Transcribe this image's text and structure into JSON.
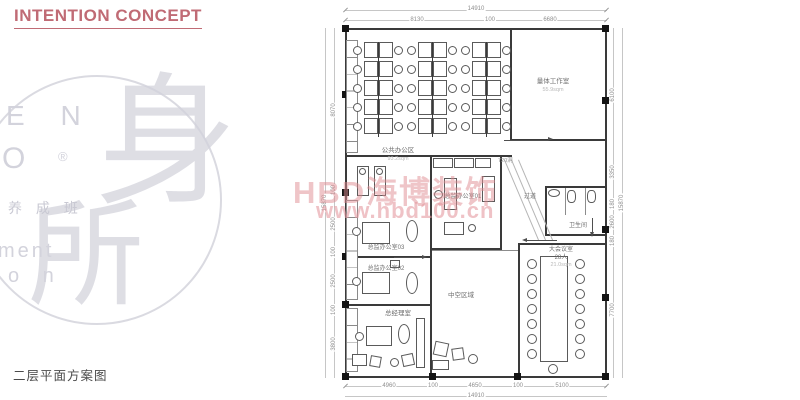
{
  "page": {
    "title": "INTENTION CONCEPT",
    "caption": "二层平面方案图"
  },
  "logo": {
    "fragment1": "E N",
    "fragment2": "O",
    "registered": "®",
    "fragment3": "养 成 班",
    "fragment4": "ment",
    "fragment5": "o n",
    "seal_char1": "身",
    "seal_char2": "所"
  },
  "watermark": {
    "brand": "HBD海博装饰",
    "url": "www.hbd100.cn"
  },
  "plan": {
    "rooms": [
      {
        "id": "open-office",
        "label": "公共办公区",
        "area": "93.2sqm"
      },
      {
        "id": "studio",
        "label": "量体工作室",
        "area": "55.9sqm"
      },
      {
        "id": "director-office-01",
        "label": "总监办公室01"
      },
      {
        "id": "corridor",
        "label": "过道"
      },
      {
        "id": "washroom",
        "label": "卫生间"
      },
      {
        "id": "meeting-room",
        "label": "大会议室",
        "capacity": "28人",
        "area": "21.0sqm"
      },
      {
        "id": "void-area",
        "label": "中空区域"
      },
      {
        "id": "director-office-03",
        "label": "总监办公室03"
      },
      {
        "id": "director-office-02",
        "label": "总监办公室02"
      },
      {
        "id": "gm-office",
        "label": "总经理室"
      }
    ],
    "annotations": {
      "opening": "720洞"
    },
    "furniture": {
      "desk_banks": 3,
      "desk_rows": 5,
      "meeting_side_chairs": 7
    },
    "dimensions": {
      "top_total": "14910",
      "top_segments": [
        "8130",
        "100",
        "6680"
      ],
      "bottom_segments": [
        "4960",
        "100",
        "4650",
        "100",
        "5100"
      ],
      "bottom_total": "14910",
      "left_segments": [
        "8070",
        "100",
        "2500",
        "100",
        "2500",
        "100",
        "3800"
      ],
      "left_total": "15870",
      "right_segments": [
        "6100",
        "3350",
        "180",
        "2600",
        "180",
        "7700"
      ],
      "right_total": "15870"
    }
  },
  "colors": {
    "accent": "#c06b75",
    "watermark_brand": "rgba(223,139,146,0.5)",
    "watermark_url": "rgba(228,150,157,0.58)",
    "plan_line": "#3a3a3a",
    "dim_text": "#8f8f8f",
    "logo_gray": "#d3d3dc"
  }
}
